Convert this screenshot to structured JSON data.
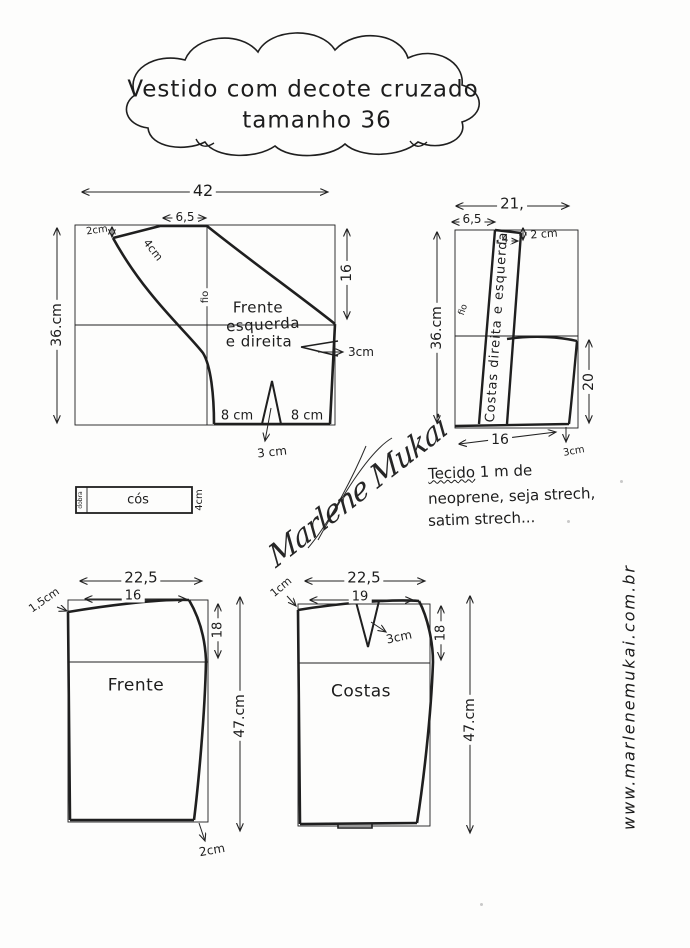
{
  "title": {
    "line1": "Vestido com decote cruzado",
    "line2": "tamanho 36"
  },
  "bodice_front": {
    "name_line1": "Frente",
    "name_line2": "esquerda",
    "name_line3": "e direita",
    "width": "42",
    "top_width": "6,5",
    "height": "36.cm",
    "side": "16",
    "strap_end": "2cm",
    "strap_width": "4cm",
    "grainline": "fio",
    "side_dart": "3cm",
    "hem_left": "8 cm",
    "hem_right": "8 cm",
    "bottom_dart": "3 cm"
  },
  "bodice_back": {
    "name": "Costas direita e esquerda",
    "width": "21,",
    "top_width": "6,5",
    "strap_top": "4",
    "strap_offset": "2 cm",
    "height": "36.cm",
    "side": "20",
    "bottom": "16",
    "corner": "3cm",
    "grainline": "fio"
  },
  "waistband": {
    "label": "cós",
    "fold": "dobra",
    "height": "4cm"
  },
  "fabric_note": {
    "word": "Tecido",
    "line1_rest": " 1 m de",
    "line2": "neoprene, seja strech,",
    "line3": "satim strech..."
  },
  "signature": "Marlene Mukai",
  "skirt_front": {
    "name": "Frente",
    "width": "22,5",
    "top_width": "16",
    "corner": "1,5cm",
    "side": "18",
    "height": "47.cm",
    "hem": "2cm"
  },
  "skirt_back": {
    "name": "Costas",
    "width": "22,5",
    "top_width": "19",
    "corner": "1cm",
    "dart": "3cm",
    "side": "18",
    "height": "47.cm"
  },
  "website": "www.marlenemukai.com.br"
}
